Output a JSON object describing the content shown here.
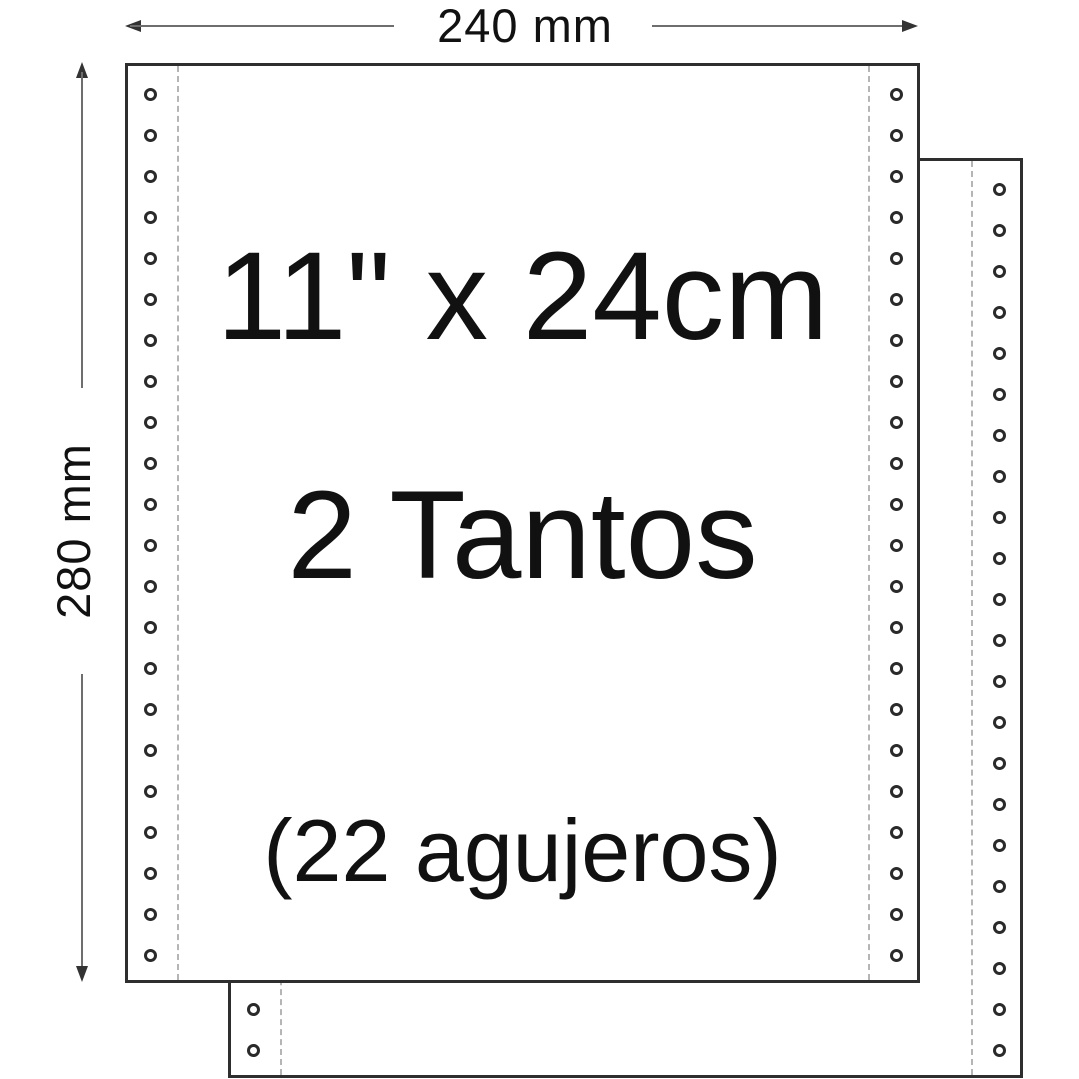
{
  "diagram": {
    "type": "continuous-form-paper-diagram",
    "dimensions": {
      "width_label": "240 mm",
      "height_label": "280 mm"
    },
    "sheet": {
      "size_label": "11\" x 24cm",
      "copies_label": "2 Tantos",
      "holes_label": "(22 agujeros)",
      "holes_per_column": 22,
      "sheet_count": 2
    },
    "colors": {
      "paper": "#ffffff",
      "outline": "#2e2e2e",
      "text": "#111111",
      "dimension_line": "#6e6e6e",
      "arrow": "#333333",
      "perforation": "#b5b5b5"
    }
  }
}
